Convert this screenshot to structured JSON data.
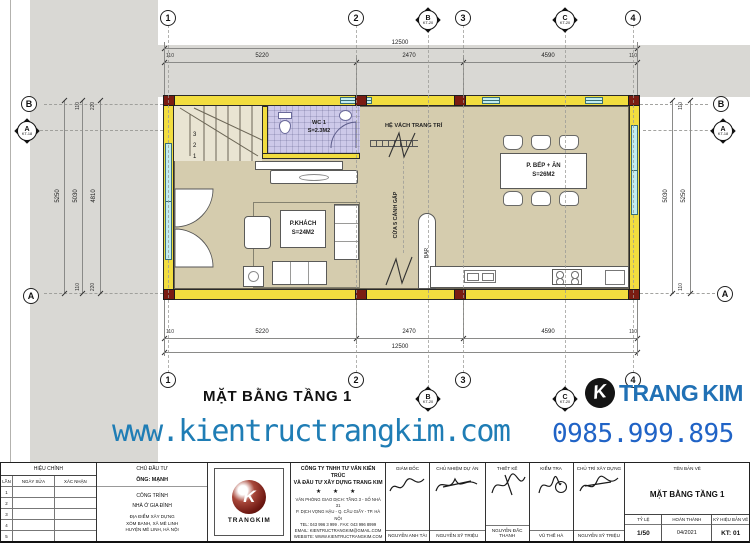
{
  "colors": {
    "wall-yellow": "#f2dd3f",
    "column-red": "#7a1c12",
    "window-cyan": "#c2edf0",
    "floor-tan": "#d5ccae",
    "wc-lavender": "#cdc9e9",
    "band-gray": "#d9d8d4",
    "line-gray": "#8a8a88",
    "web-blue": "#1f7db5",
    "phone-blue": "#2063c6",
    "brand-blue": "#2171b5",
    "logo-maroon": "#6e1812"
  },
  "plan": {
    "title": "MẶT BẰNG TẦNG 1",
    "rooms": {
      "wc": {
        "name": "WC 1",
        "area": "S=2.3M2"
      },
      "living": {
        "name": "P.KHÁCH",
        "area": "S=24M2"
      },
      "kitchen": {
        "name": "P. BẾP + ĂN",
        "area": "S=26M2"
      }
    },
    "labels": {
      "deco_wall": "HỆ VÁCH TRANG TRÍ",
      "folding_door": "CỬA 5 CÁNH GẤP",
      "bar": "BAR",
      "stair_steps": [
        "3",
        "2",
        "1"
      ]
    },
    "grid": {
      "cols": [
        "1",
        "2",
        "3",
        "4"
      ],
      "rows": {
        "top": "B",
        "bottom": "A"
      },
      "section_b": {
        "letter": "B",
        "ref": "KT-20"
      },
      "section_c": {
        "letter": "C",
        "ref": "KT-20"
      },
      "section_a": {
        "letter": "A",
        "ref": "KT-18"
      }
    },
    "dims": {
      "total": "12500",
      "top": [
        "110",
        "5220",
        "2470",
        "4590",
        "110"
      ],
      "bottom": [
        "110",
        "5220",
        "2470",
        "4590",
        "110"
      ],
      "left_main": [
        "5250",
        "5030",
        "4810"
      ],
      "left_top": [
        "110",
        "220"
      ],
      "left_bottom": [
        "110",
        "220"
      ],
      "right_main": [
        "5030",
        "5250"
      ],
      "right_top": [
        "110"
      ],
      "right_bottom": [
        "110"
      ]
    }
  },
  "footer": {
    "website": "www.kientructrangkim.com",
    "phone": "0985.999.895",
    "brand": {
      "part1": "TRANG",
      "part2": "KIM",
      "icon_letter": "K"
    }
  },
  "title_block": {
    "revision": {
      "header": "HIỆU CHỈNH",
      "columns": [
        "LẦN",
        "NGÀY SỬA",
        "XÁC NHẬN"
      ],
      "rows": [
        "1",
        "2",
        "3",
        "4",
        "5"
      ]
    },
    "client": {
      "header": "CHỦ ĐẦU TƯ",
      "name": "ÔNG: MẠNH",
      "project_header": "CÔNG TRÌNH",
      "project": "NHÀ Ở GIA ĐÌNH",
      "location": [
        "ĐỊA ĐIỂM XÂY DỰNG",
        "XÓM BANH, XÃ MÊ LINH",
        "HUYỆN MÊ LINH, HÀ NỘI"
      ]
    },
    "logo_text": "TRANGKIM",
    "logo_letter": "K",
    "company": {
      "name_line1": "CÔNG TY TNHH TƯ VẤN KIẾN TRÚC",
      "name_line2": "VÀ ĐẦU TƯ XÂY DỰNG TRANG KIM",
      "stars": "★ ★ ★",
      "address": [
        "VĂN PHÒNG GIAO DỊCH: TẦNG 3 - SỐ NHÀ 31",
        "P. DỊCH VỌNG HẬU - Q. CẦU GIẤY - TP. HÀ NỘI",
        "TEL: 043 996 3 999 . FAX: 043 996 8999",
        "EMAIL: KIENTRUCTRANGKIM@GMAIL.COM",
        "WEBSITE: WWW.KIENTRUCTRANGKIM.COM"
      ]
    },
    "signatures": [
      {
        "role": "GIÁM ĐỐC",
        "name": "NGUYỄN ANH TÀI"
      },
      {
        "role": "CHỦ NHIỆM DỰ ÁN",
        "name": "NGUYỄN SỸ TRIỆU"
      },
      {
        "role": "THIẾT KẾ",
        "name": "NGUYỄN ĐẮC THANH"
      },
      {
        "role": "KIỂM TRA",
        "name": "VŨ THẾ HÀ"
      },
      {
        "role": "CHỦ TRÌ XÂY DỰNG",
        "name": "NGUYỄN SỸ TRIỆU"
      }
    ],
    "drawing": {
      "name_label": "TÊN BẢN VẼ",
      "name": "MẶT BẰNG TẦNG 1",
      "scale_label": "TỶ LỆ",
      "scale": "1/50",
      "date_label": "HOÀN THÀNH",
      "date": "04/2021",
      "code_label": "KÝ HIỆU BẢN VẼ",
      "code": "KT: 01"
    }
  }
}
